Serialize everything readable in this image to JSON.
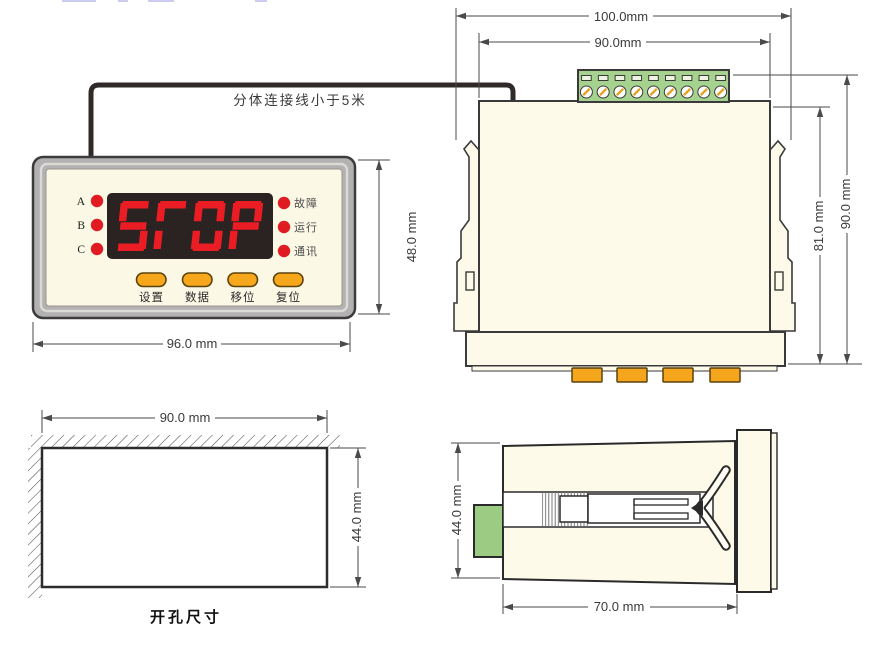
{
  "connection_note": "分体连接线小于5米",
  "front_view": {
    "phase_leds": [
      "A",
      "B",
      "C"
    ],
    "status_leds": [
      "故障",
      "运行",
      "通讯"
    ],
    "display_text": "STOP",
    "buttons": [
      "设置",
      "数据",
      "移位",
      "复位"
    ],
    "width_dim": "96.0 mm",
    "height_dim": "48.0 mm"
  },
  "rear_view": {
    "overall_width_dim": "100.0mm",
    "body_width_dim": "90.0mm",
    "body_height_dim": "81.0 mm",
    "overall_height_dim": "90.0 mm",
    "terminal_count": 9
  },
  "cutout_view": {
    "width_dim": "90.0 mm",
    "height_dim": "44.0 mm",
    "caption": "开孔尺寸"
  },
  "side_view": {
    "height_dim": "44.0 mm",
    "depth_dim": "70.0 mm"
  },
  "colors": {
    "led_red": "#e01b22",
    "segment_red": "#ea1c24",
    "display_bg": "#2a2321",
    "button_orange": "#f7a71b",
    "terminal_green": "#a6d28f",
    "body_cream": "#fdfae9",
    "panel_cream": "#fcf8e6",
    "frame_gray": "#b3b1b1",
    "line_dark": "#3a3a3a"
  }
}
